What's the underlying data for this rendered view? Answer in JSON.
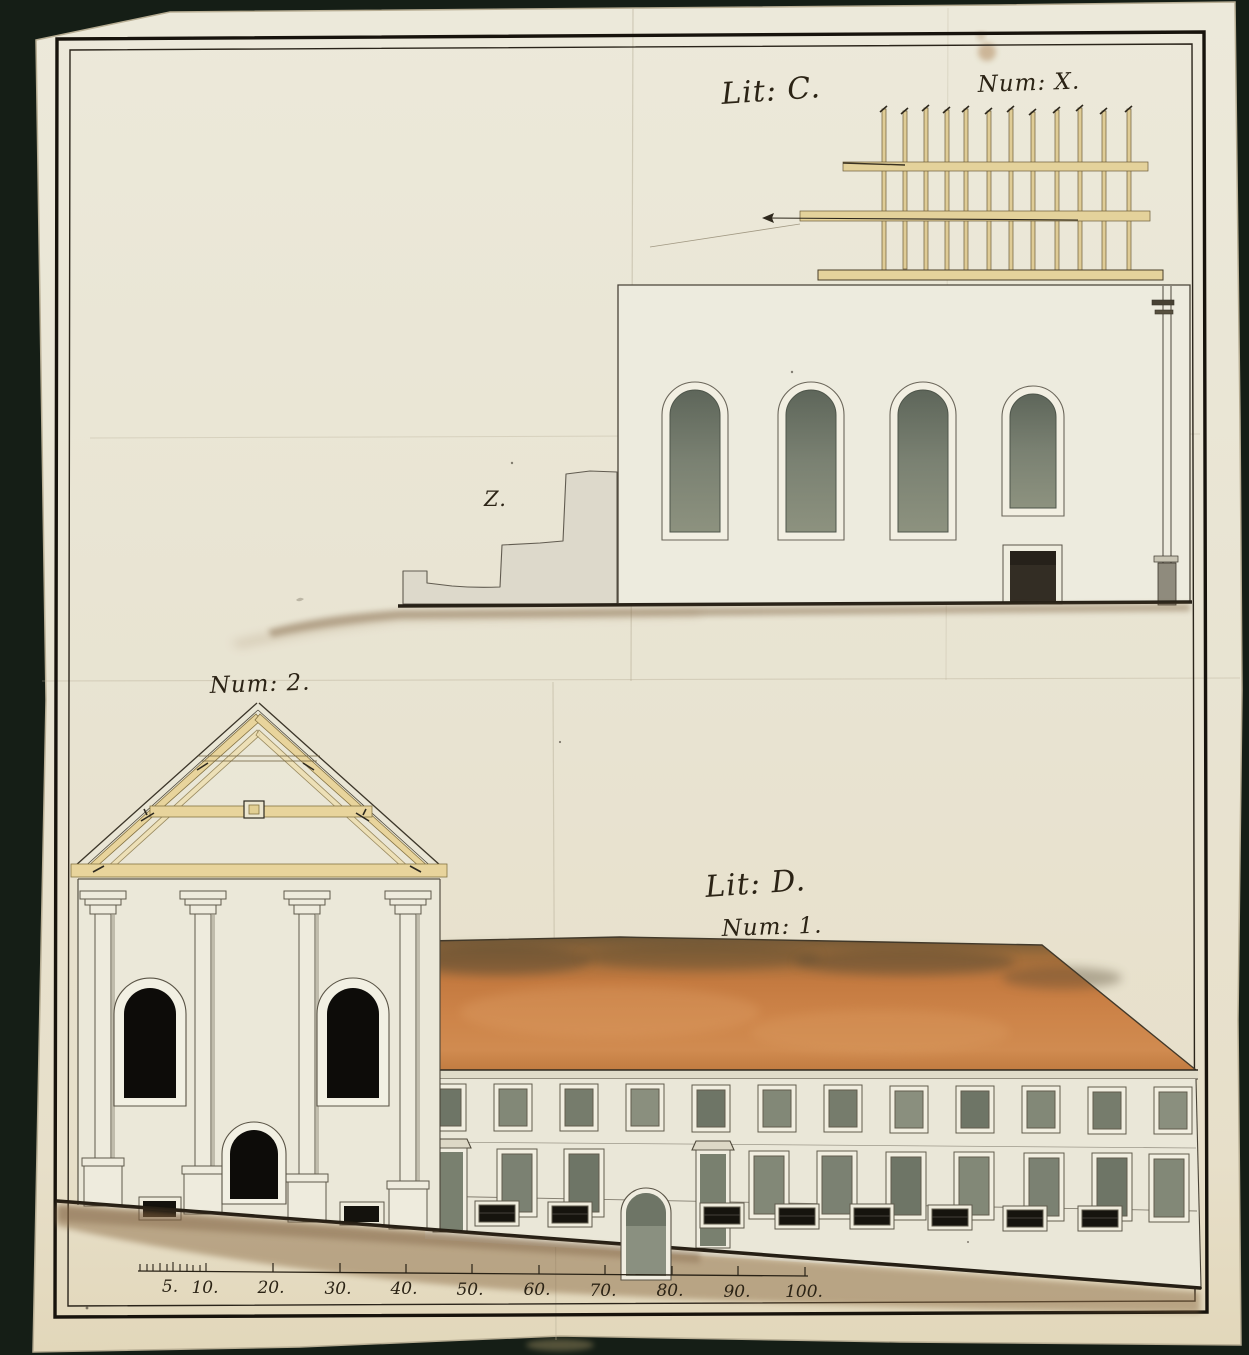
{
  "sheet": {
    "labels": {
      "top_lit": "Lit: C.",
      "top_num": "Num: X.",
      "ruin": "Z.",
      "facade_num": "Num: 2.",
      "bottom_lit": "Lit: D.",
      "bottom_num": "Num: 1."
    },
    "scale_bar": {
      "labels": [
        "5.",
        "10.",
        "20.",
        "30.",
        "40.",
        "50.",
        "60.",
        "70.",
        "80.",
        "90.",
        "100."
      ]
    },
    "colors": {
      "background": "#1b261d",
      "paper": "#e9e5d4",
      "ink": "#241f15",
      "roof_orange": "#c9803f",
      "timber_tan": "#e8d49c",
      "glazing_gray": "#79806f",
      "ground_wash": "#8a6a45"
    }
  }
}
